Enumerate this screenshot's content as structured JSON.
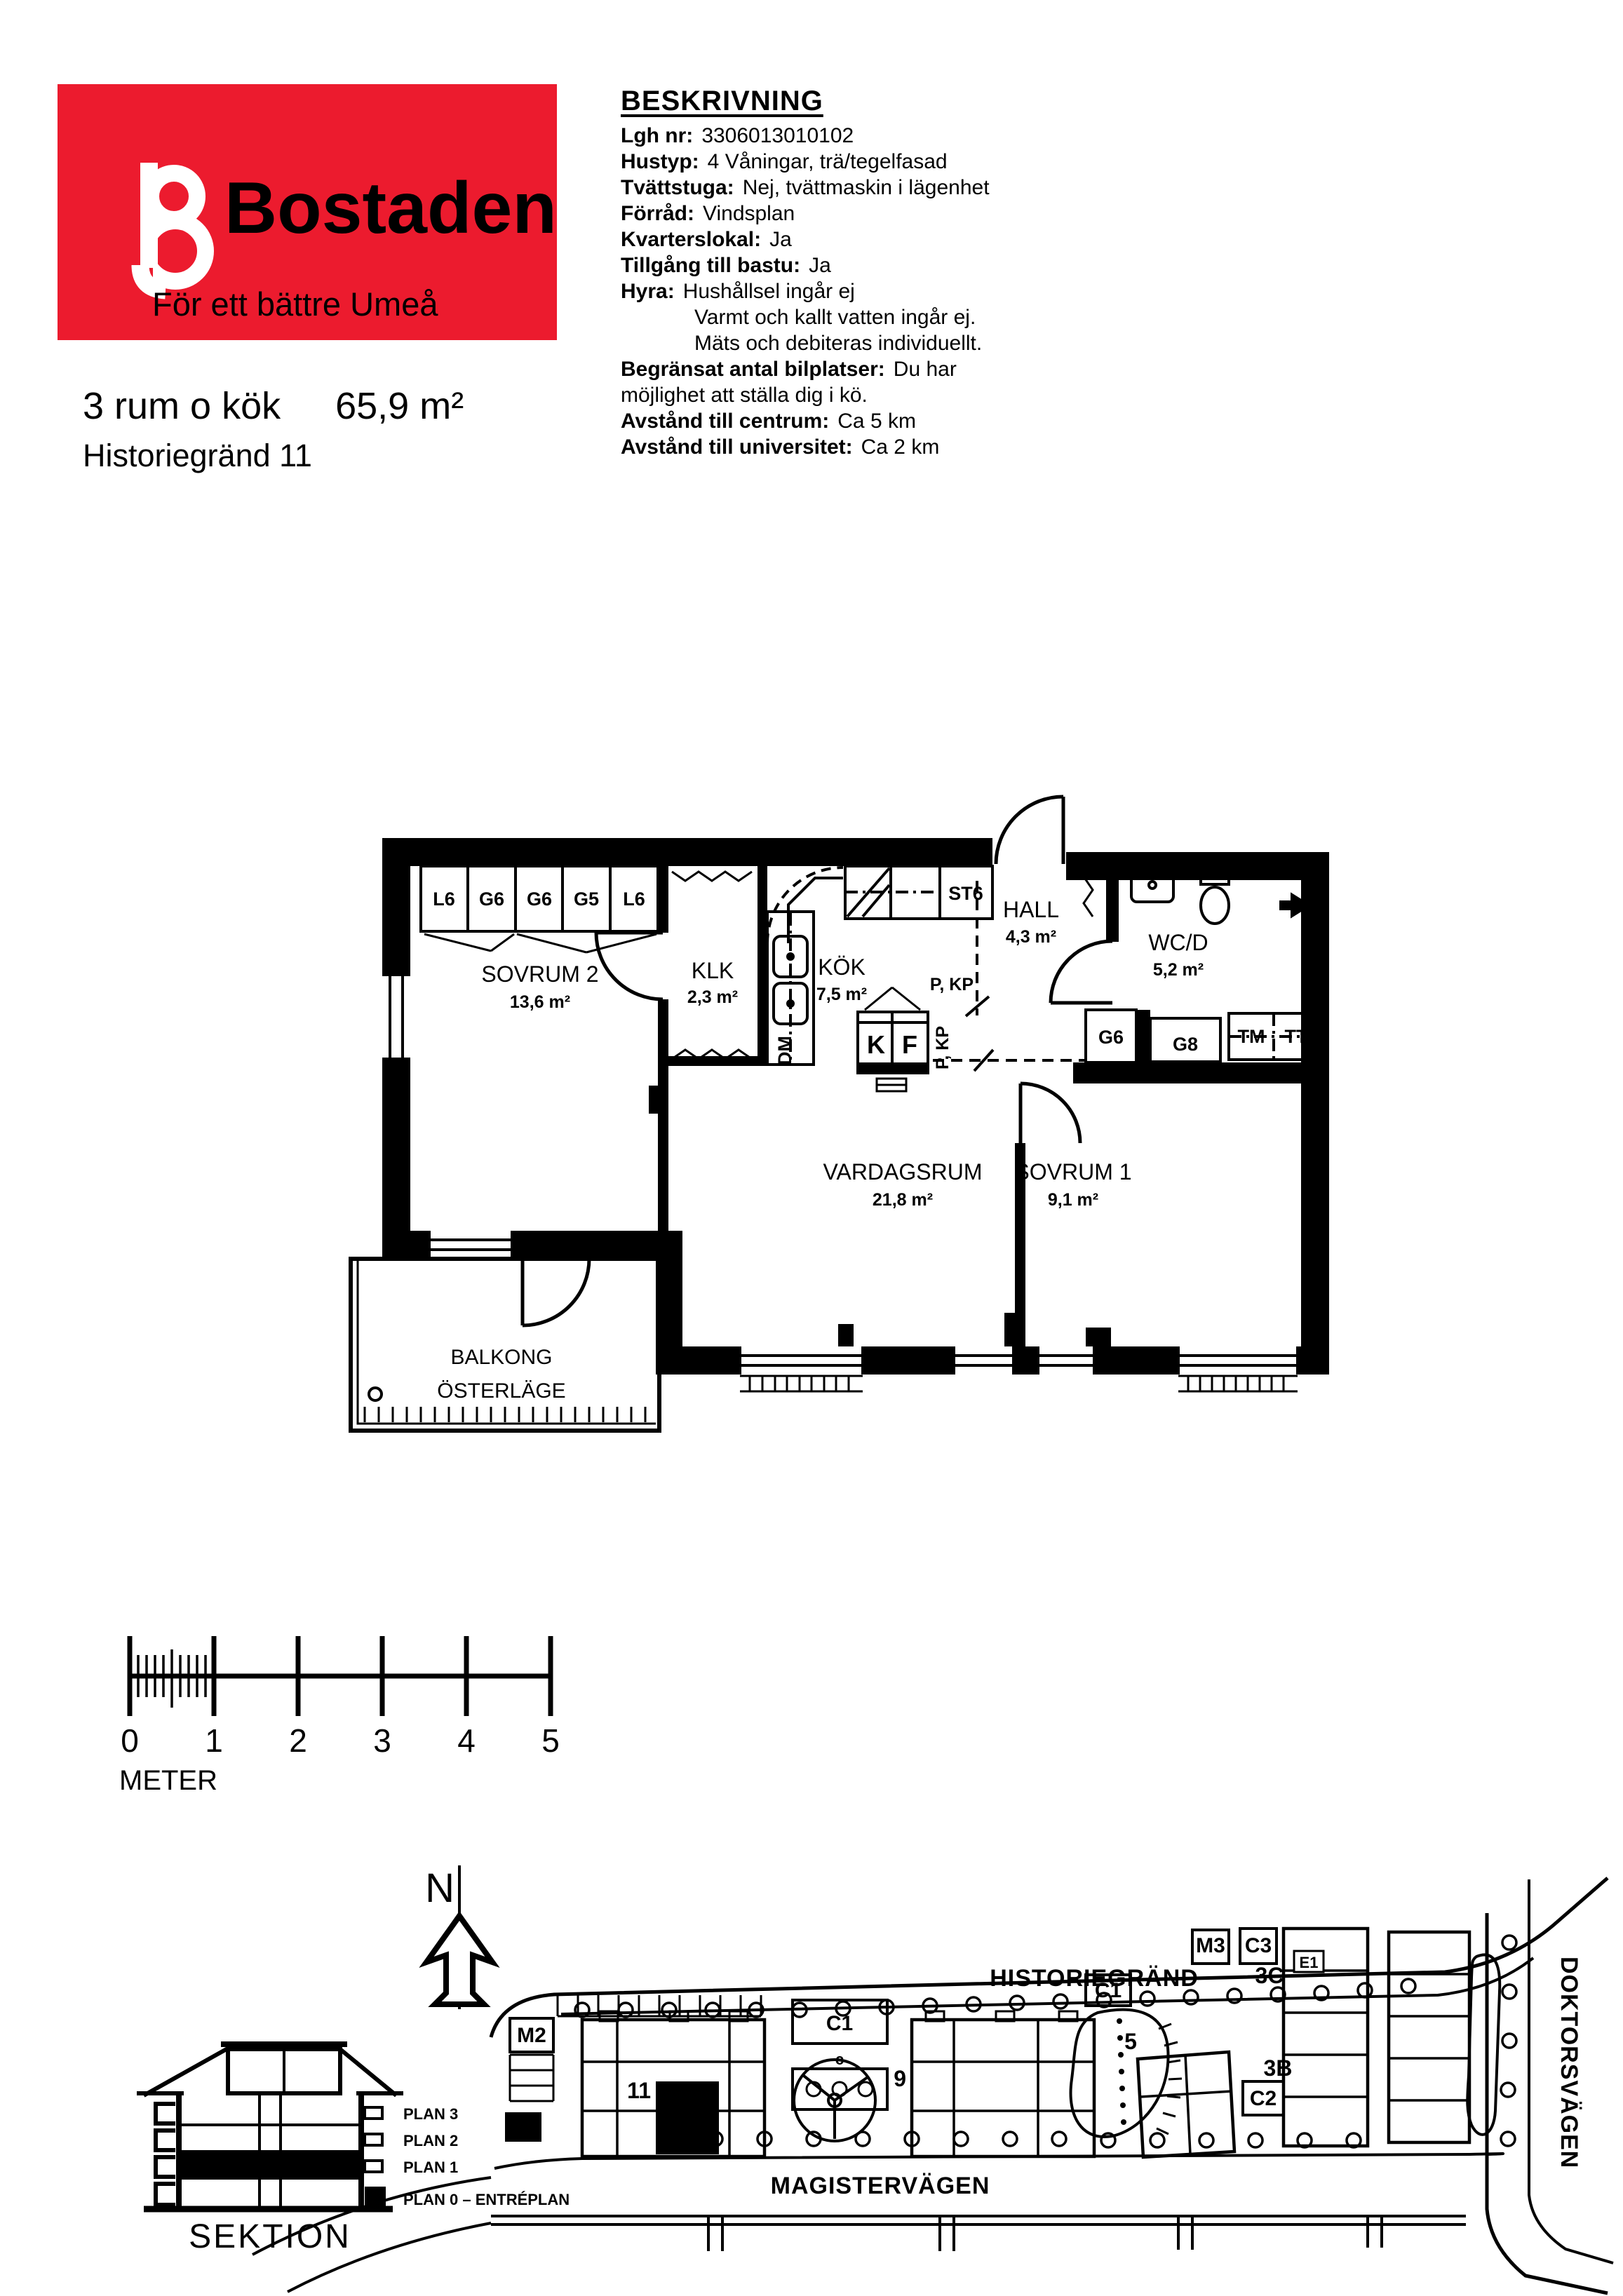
{
  "brand": {
    "name": "Bostaden",
    "tagline": "För ett bättre Umeå",
    "red": "#EC1B2E"
  },
  "listing": {
    "size_title": "3 rum o kök",
    "area": "65,9 m²",
    "address": "Historiegränd 11"
  },
  "description": {
    "heading": "BESKRIVNING",
    "rows": [
      {
        "label": "Lgh nr:",
        "value": "3306013010102"
      },
      {
        "label": "Hustyp:",
        "value": "4 Våningar, trä/tegelfasad"
      },
      {
        "label": "Tvättstuga:",
        "value": "Nej, tvättmaskin i lägenhet"
      },
      {
        "label": "Förråd:",
        "value": "Vindsplan"
      },
      {
        "label": "Kvarterslokal:",
        "value": "Ja"
      },
      {
        "label": "Tillgång till bastu:",
        "value": "Ja"
      },
      {
        "label": "Hyra:",
        "value": "Hushållsel ingår ej"
      },
      {
        "label": "",
        "value": "Varmt och kallt vatten ingår ej."
      },
      {
        "label": "",
        "value": "Mäts och debiteras individuellt."
      },
      {
        "label": "Begränsat antal bilplatser:",
        "value": "Du har"
      },
      {
        "label": "",
        "value": "möjlighet att ställa dig i kö."
      },
      {
        "label": "Avstånd till centrum:",
        "value": "Ca 5 km"
      },
      {
        "label": "Avstånd till universitet:",
        "value": "Ca 2 km"
      }
    ]
  },
  "floorplan": {
    "rooms": [
      {
        "name": "SOVRUM 2",
        "area": "13,6 m²"
      },
      {
        "name": "KLK",
        "area": "2,3 m²"
      },
      {
        "name": "KÖK",
        "area": "7,5 m²"
      },
      {
        "name": "HALL",
        "area": "4,3 m²"
      },
      {
        "name": "WC/D",
        "area": "5,2 m²"
      },
      {
        "name": "VARDAGSRUM",
        "area": "21,8 m²"
      },
      {
        "name": "SOVRUM 1",
        "area": "9,1 m²"
      }
    ],
    "balcony_line1": "BALKONG",
    "balcony_line2": "ÖSTERLÄGE",
    "wardrobes": [
      "L6",
      "G6",
      "G6",
      "G5",
      "L6"
    ],
    "cabinets": {
      "st6": "ST6",
      "dm": "DM",
      "k": "K",
      "f": "F",
      "g6": "G6",
      "g8": "G8",
      "tm": "TM",
      "tt": "TT"
    },
    "pipe_marker": "P, KP"
  },
  "scalebar": {
    "ticks": [
      "0",
      "1",
      "2",
      "3",
      "4",
      "5"
    ],
    "unit": "METER"
  },
  "section": {
    "title": "SEKTION",
    "floors": [
      "PLAN 3",
      "PLAN 2",
      "PLAN 1",
      "PLAN 0 – ENTRÉPLAN"
    ]
  },
  "siteplan": {
    "compass": "N",
    "streets": {
      "north": "HISTORIEGRÄND",
      "south": "MAGISTERVÄGEN",
      "east": "DOKTORSVÄGEN"
    },
    "labels": {
      "m2": "M2",
      "c1": "C1",
      "c": "c",
      "b11": "11",
      "b9": "9",
      "b7": "7",
      "b5": "5",
      "m3": "M3",
      "c3": "C3",
      "b3c": "3C",
      "b3b": "3B",
      "c2": "C2",
      "e1": "E1"
    }
  }
}
